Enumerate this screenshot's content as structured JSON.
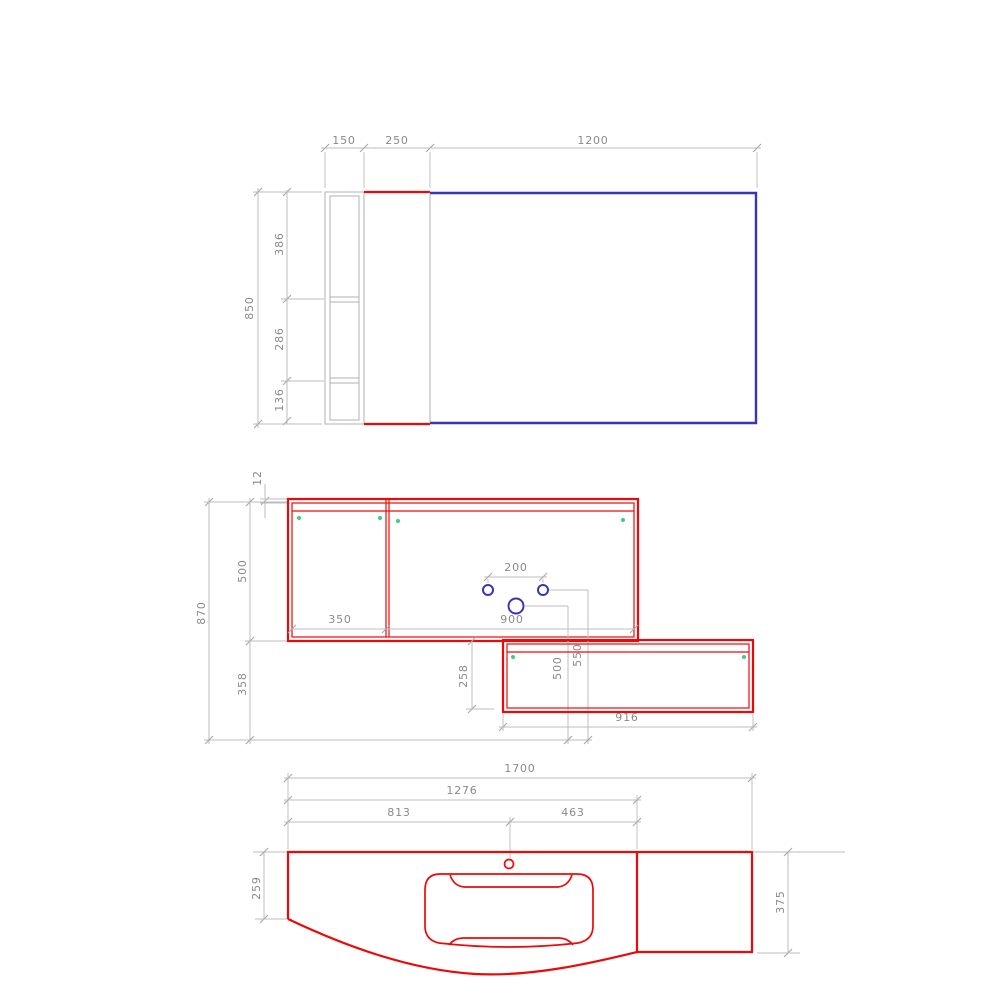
{
  "drawing_type": "bathroom-vanity-technical-drawing",
  "colors": {
    "red": "#ee0909",
    "blue": "#3a35b2",
    "green": "#3fcf7c",
    "dim_line": "#bcbcbc",
    "dim_tick": "#a8a8a8",
    "dim_text": "#8a8a8a",
    "shape_gray": "#b0b0b0"
  },
  "views": {
    "plan": {
      "dims": {
        "side_depth": "150",
        "cabinet_depth": "250",
        "panel_width": "1200",
        "total_height": "850",
        "seg_top": "386",
        "seg_mid": "286",
        "seg_bottom": "136"
      }
    },
    "front": {
      "dims": {
        "top_thickness": "12",
        "total_height": "870",
        "cabinet_height": "500",
        "below_height": "358",
        "left_door_width": "350",
        "right_section_width": "900",
        "hole_spacing": "200",
        "drawer_drop": "258",
        "hole_height_a": "500",
        "hole_height_b": "550",
        "drawer_width": "916"
      }
    },
    "counter": {
      "dims": {
        "total_width": "1700",
        "to_divider": "1276",
        "to_faucet": "813",
        "faucet_to_divider": "463",
        "left_depth": "259",
        "right_depth": "375"
      }
    }
  }
}
